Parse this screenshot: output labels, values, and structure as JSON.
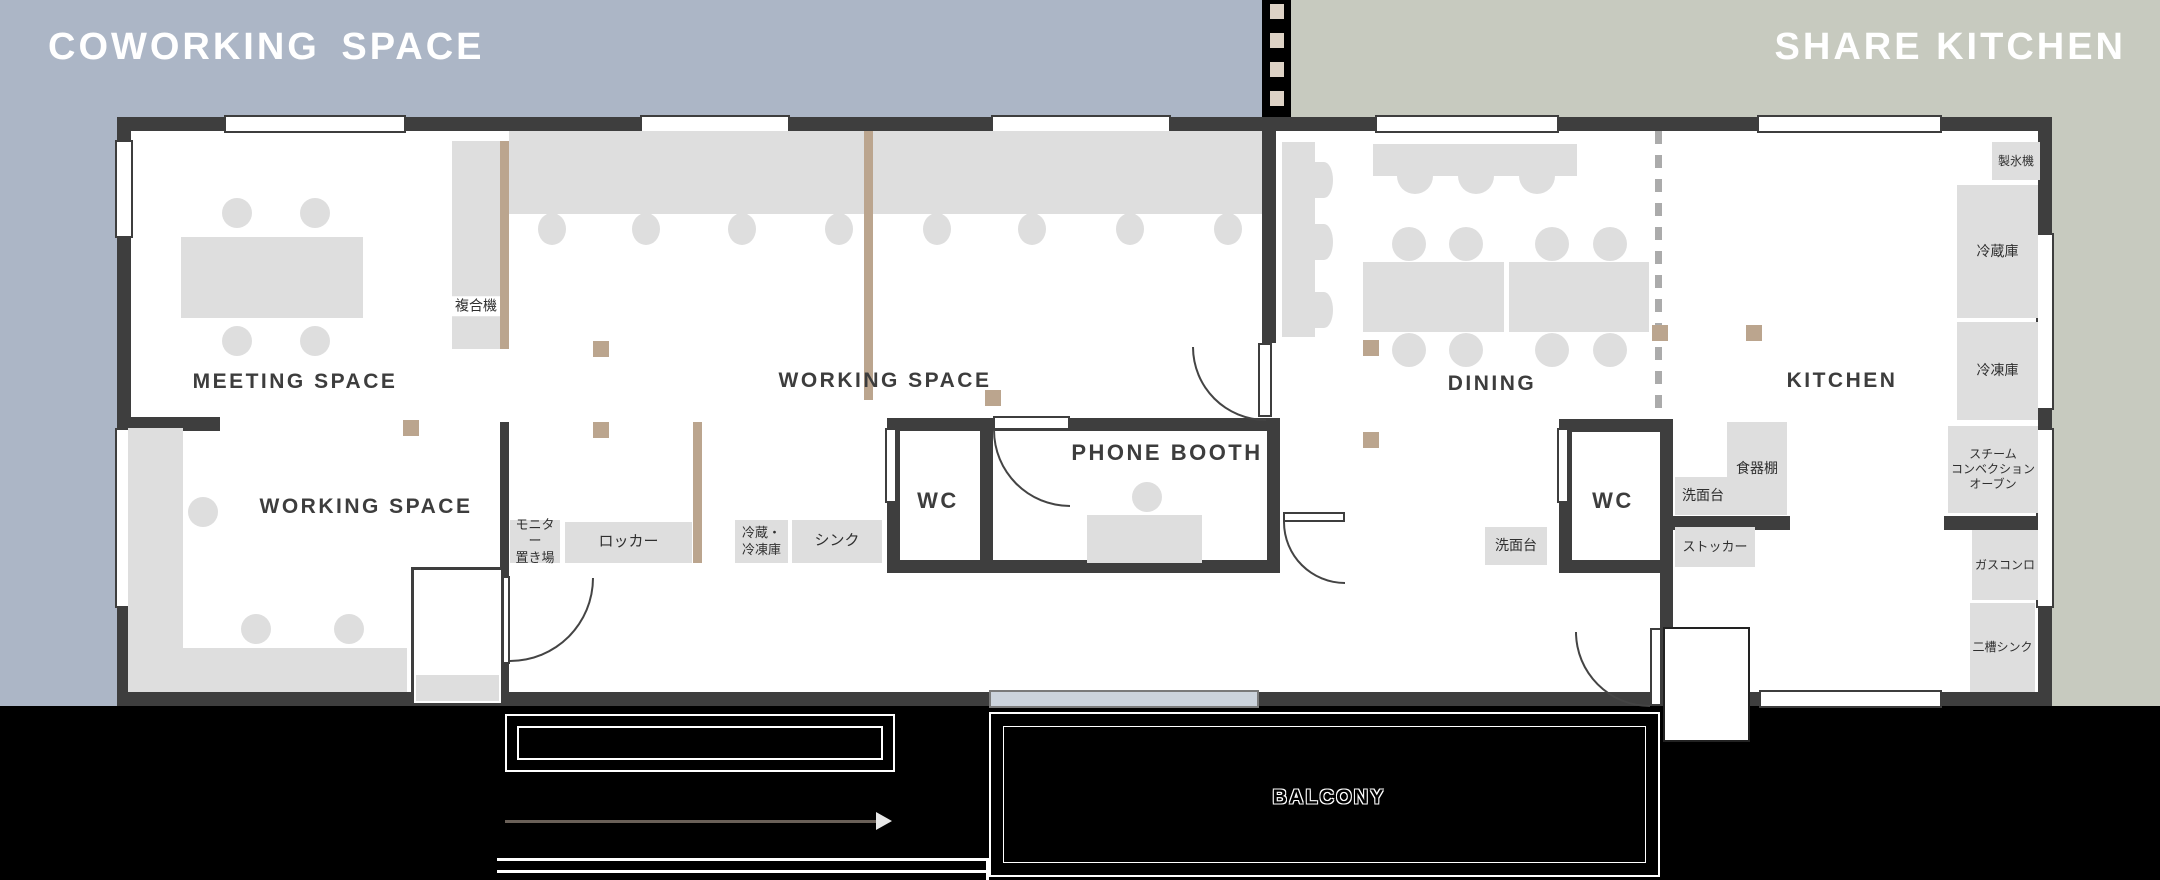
{
  "zones": {
    "coworking": "COWORKING  SPACE",
    "share_kitchen": "SHARE KITCHEN"
  },
  "rooms": {
    "meeting": "MEETING SPACE",
    "working_upper": "WORKING SPACE",
    "working_lower": "WORKING SPACE",
    "dining": "DINING",
    "kitchen": "KITCHEN",
    "phone_booth": "PHONE BOOTH",
    "wc_left": "WC",
    "wc_right": "WC",
    "balcony": "BALCONY"
  },
  "labels": {
    "copier": "複合機",
    "monitor_storage": "モニター\n置き場",
    "locker": "ロッカー",
    "fridge_freezer": "冷蔵・\n冷凍庫",
    "sink": "シンク",
    "washstand_left": "洗面台",
    "washstand_right": "洗面台",
    "cupboard": "食器棚",
    "stocker": "ストッカー",
    "ice_maker": "製氷機",
    "refrigerator": "冷蔵庫",
    "freezer": "冷凍庫",
    "steam_oven": "スチーム\nコンベクション\nオーブン",
    "gas_stove": "ガスコンロ",
    "double_sink": "二槽シンク"
  },
  "colors": {
    "coworking_bg": "#acb6c6",
    "share_kitchen_bg": "#c7cabf",
    "wall": "#3e3e3e",
    "furniture": "#dedede",
    "accent_tan": "#bba58e",
    "outside": "#000000"
  }
}
